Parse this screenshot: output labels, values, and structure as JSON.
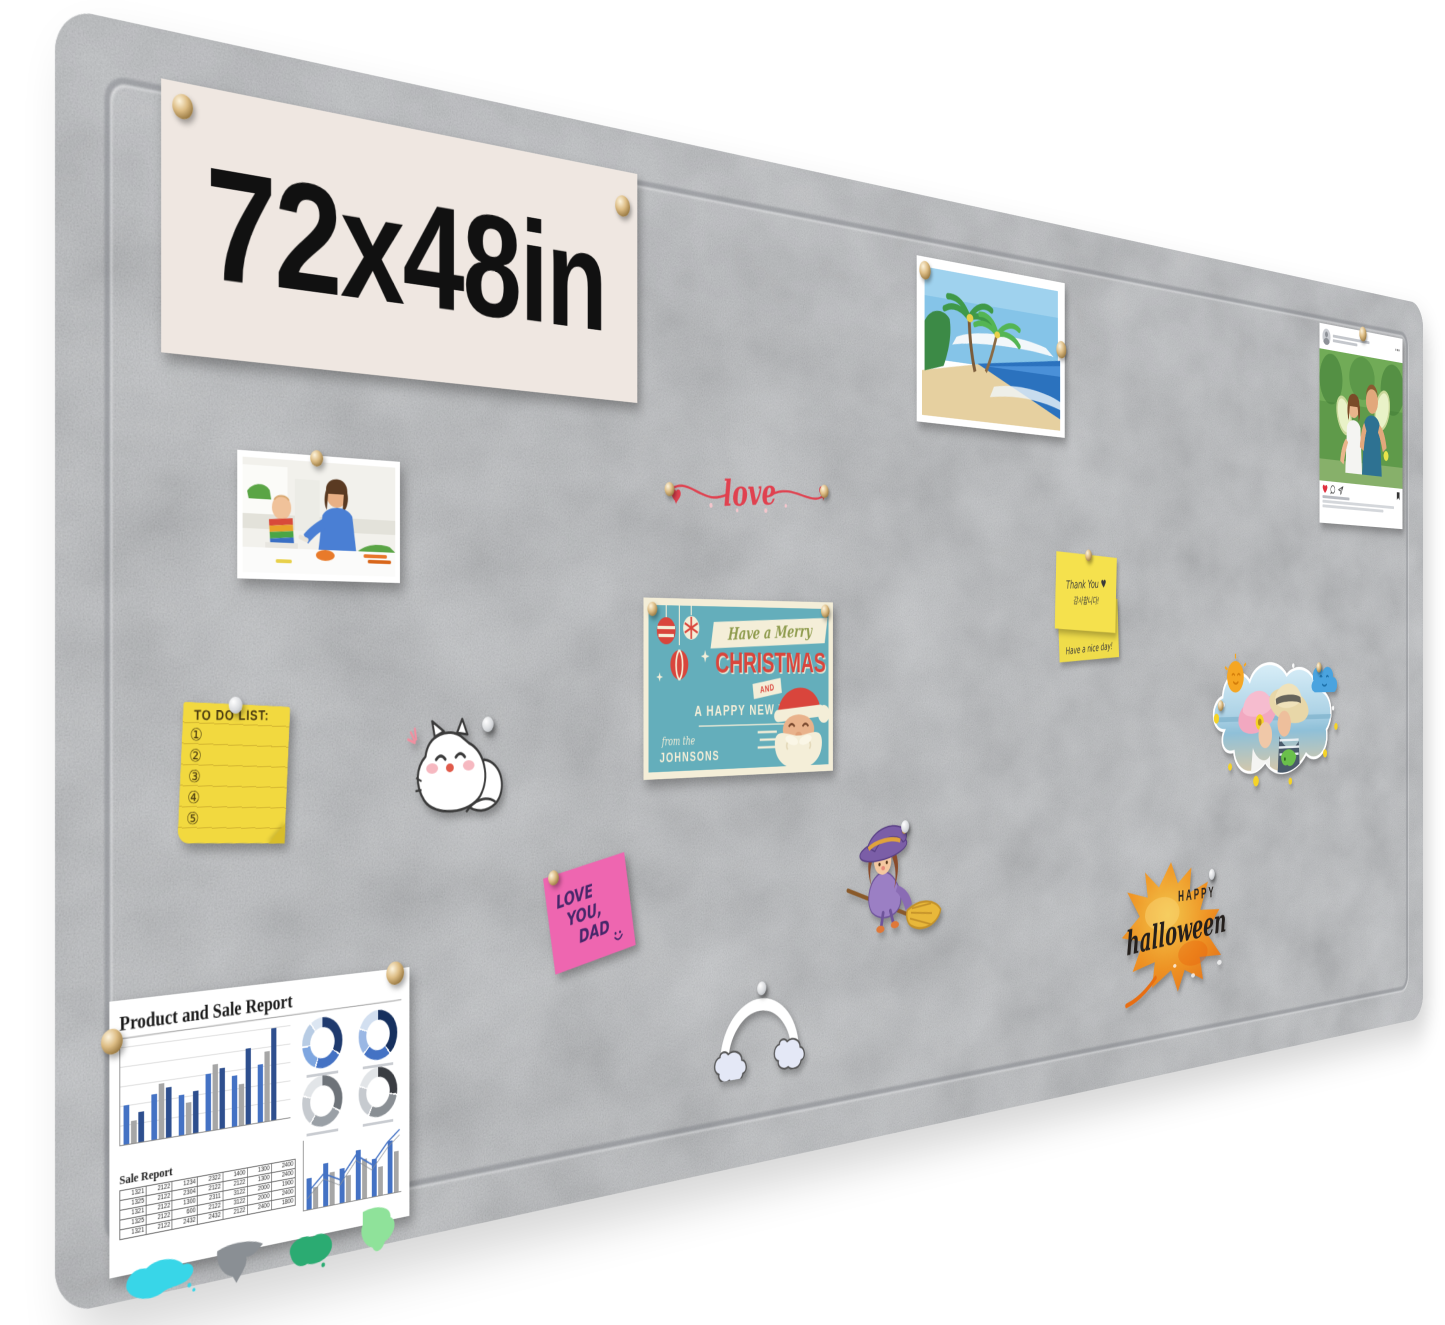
{
  "image_type": "product photo of a gray felt pin board with pinned decorations",
  "colors": {
    "felt_base": "#b6b9bd",
    "banner_bg": "#efe7e1",
    "banner_text": "#111111",
    "love_red": "#e0414f",
    "christmas_teal": "#64aebb",
    "christmas_cream": "#f4eed8",
    "christmas_red": "#d9453c",
    "sticky_yellow": "#f5e14d",
    "todo_yellow": "#f2d93f",
    "pink_note": "#ee66b0",
    "leaf_orange": "#f2921d",
    "report_blue": "#4472c4",
    "report_dark_blue": "#2e4f8e",
    "report_gray": "#a6a6a6"
  },
  "banner": {
    "label": "72x48in"
  },
  "love_decoration": {
    "text": "love"
  },
  "christmas_card": {
    "script_line": "Have a Merry",
    "title": "CHRISTMAS",
    "and": "AND",
    "subtitle": "A HAPPY NEW YEAR",
    "from": "from the",
    "family": "JOHNSONS"
  },
  "sticky_notes": {
    "top_line1": "Thank You ♥",
    "top_line2": "감사합니다!",
    "bottom_line": "Have a nice day!"
  },
  "todo_list": {
    "title": "TO DO LIST:",
    "numbers": [
      "①",
      "②",
      "③",
      "④",
      "⑤"
    ]
  },
  "pink_note": {
    "line1": "LOVE",
    "line2": "YOU,",
    "line3": "DAD"
  },
  "halloween_leaf": {
    "line1": "HAPPY",
    "line2": "halloween"
  },
  "instagram_card": {
    "icons": [
      "user-avatar-icon",
      "more-dots-icon",
      "heart-icon",
      "comment-icon",
      "share-icon",
      "bookmark-icon"
    ],
    "note": "username and caption are illegible gray bars in the photo"
  },
  "report": {
    "title": "Product and Sale Report",
    "table_title": "Sale Report",
    "table_rows": [
      [
        "1321",
        "2122",
        "1234",
        "2322",
        "1400",
        "1300",
        "2400"
      ],
      [
        "1325",
        "2122",
        "2304",
        "2122",
        "2122",
        "1300",
        "2400"
      ],
      [
        "1321",
        "2122",
        "1300",
        "2311",
        "3122",
        "2000",
        "1900"
      ],
      [
        "1325",
        "2122",
        "600",
        "2122",
        "3122",
        "2000",
        "2400"
      ],
      [
        "1321",
        "2122",
        "2432",
        "2432",
        "2122",
        "2400",
        "1800"
      ]
    ],
    "chart_data": [
      {
        "type": "bar",
        "title": "grouped product bars (unlabeled)",
        "series": [
          {
            "name": "series-blue",
            "values": [
              38,
              45,
              40,
              58,
              52,
              60
            ]
          },
          {
            "name": "series-gray",
            "values": [
              22,
              55,
              32,
              66,
              42,
              72
            ]
          },
          {
            "name": "series-darkblue",
            "values": [
              30,
              50,
              42,
              62,
              78,
              95
            ]
          }
        ],
        "categories": [
          "1",
          "2",
          "3",
          "4",
          "5",
          "6"
        ]
      },
      {
        "type": "bar",
        "title": "sale combo chart with trend line (unlabeled)",
        "series": [
          {
            "name": "blue",
            "values": [
              45,
              62,
              50,
              72,
              55,
              78
            ]
          },
          {
            "name": "gray",
            "values": [
              30,
              48,
              38,
              58,
              42,
              60
            ]
          }
        ],
        "line_points": "4,58 22,40 40,50 58,26 76,40 94,18 108,6"
      }
    ],
    "donuts": [
      {
        "segments": [
          [
            "#1f3a6e",
            120
          ],
          [
            "#4472c4",
            75
          ],
          [
            "#7ea6e0",
            60
          ],
          [
            "#b8cce4",
            55
          ],
          [
            "#dce6f2",
            42
          ]
        ]
      },
      {
        "segments": [
          [
            "#16305e",
            140
          ],
          [
            "#4472c4",
            82
          ],
          [
            "#9ab7e4",
            58
          ],
          [
            "#d2dff0",
            72
          ]
        ]
      },
      {
        "segments": [
          [
            "#6e7379",
            118
          ],
          [
            "#9aa0a6",
            92
          ],
          [
            "#c6cacf",
            68
          ],
          [
            "#e2e5e8",
            74
          ]
        ]
      },
      {
        "segments": [
          [
            "#3a3d42",
            100
          ],
          [
            "#8a8f94",
            104
          ],
          [
            "#c6cacf",
            76
          ],
          [
            "#e2e5e8",
            72
          ]
        ]
      }
    ]
  }
}
